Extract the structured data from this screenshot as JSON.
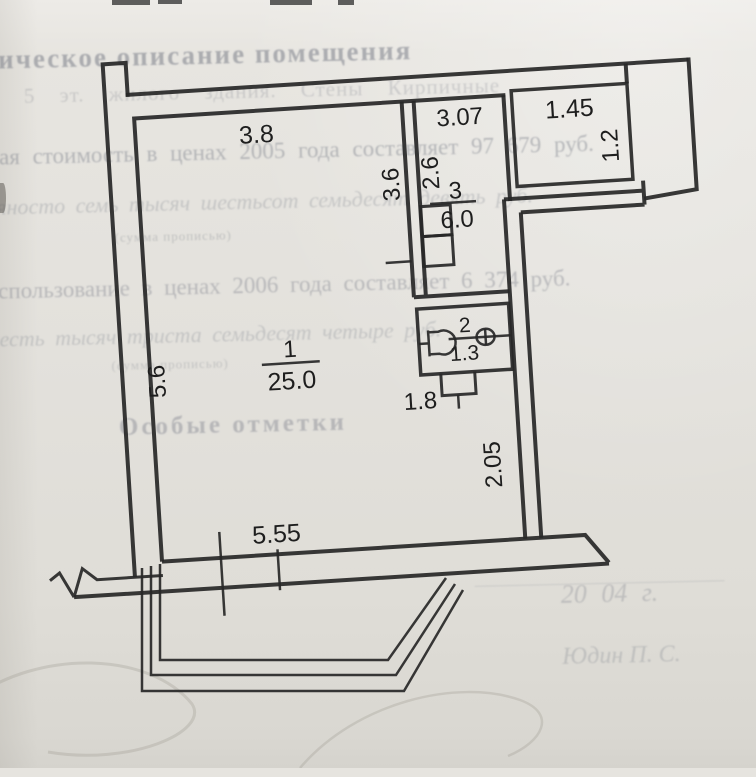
{
  "document": {
    "kind": "scanned floor plan page",
    "paper_color": "#e3e1dc",
    "line_color": "#272727"
  },
  "plan": {
    "rooms": [
      {
        "number": "1",
        "area": "25.0"
      },
      {
        "number": "2",
        "area": "1.3"
      },
      {
        "number": "3",
        "area": "6.0"
      }
    ],
    "labels": {
      "top_width": "3.8",
      "hall_width": "3.07",
      "balcony_width": "1.45",
      "balcony_depth": "1.2",
      "hall_left_height": "2.6",
      "partition_height": "3.6",
      "room1_left_height": "5.6",
      "bath_width": "1.8",
      "right_wall_lower": "2.05",
      "bottom_width": "5.55"
    }
  },
  "bleedthrough": {
    "header": "ническое описание помещения",
    "walls_line": "этаж 5 эт. жилого здания. Стены Кирпичные",
    "value_2005": "ная стоимость в ценах 2005 года составляет 97 679 руб.",
    "words_2005": "девяносто семь тысяч шестьсот семьдесят девять руб.",
    "caption_sum_1": "(сумма прописью)",
    "value_2006": "использование в ценах 2006 года составляет 6 374 руб.",
    "words_2006": "шесть тысяч триста семьдесят четыре руб.",
    "caption_sum_2": "(сумма прописью)",
    "special_marks": "Особые отметки",
    "date_line": "20  04  г.",
    "signature": "Юдин П. С."
  }
}
